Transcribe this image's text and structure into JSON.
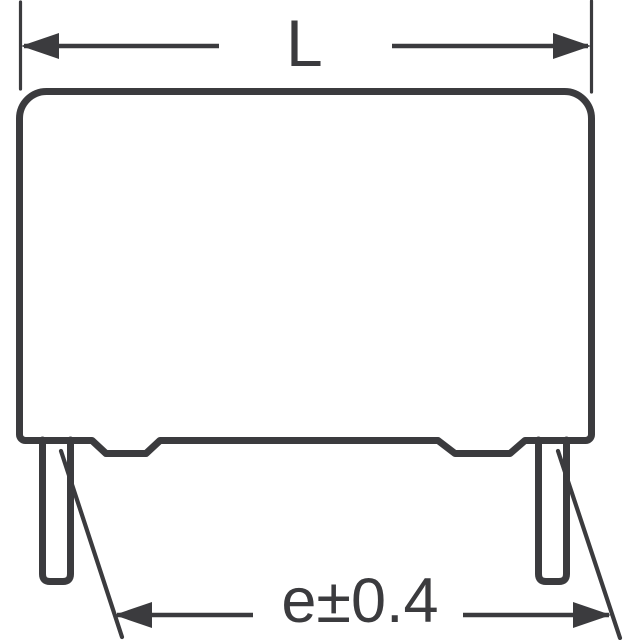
{
  "diagram": {
    "title": "capacitor-outline-dimension-drawing",
    "labels": {
      "length": "L",
      "lead_spacing": "e±0.4"
    }
  },
  "colors": {
    "line": "#3b3b3e",
    "background": "#ffffff"
  }
}
